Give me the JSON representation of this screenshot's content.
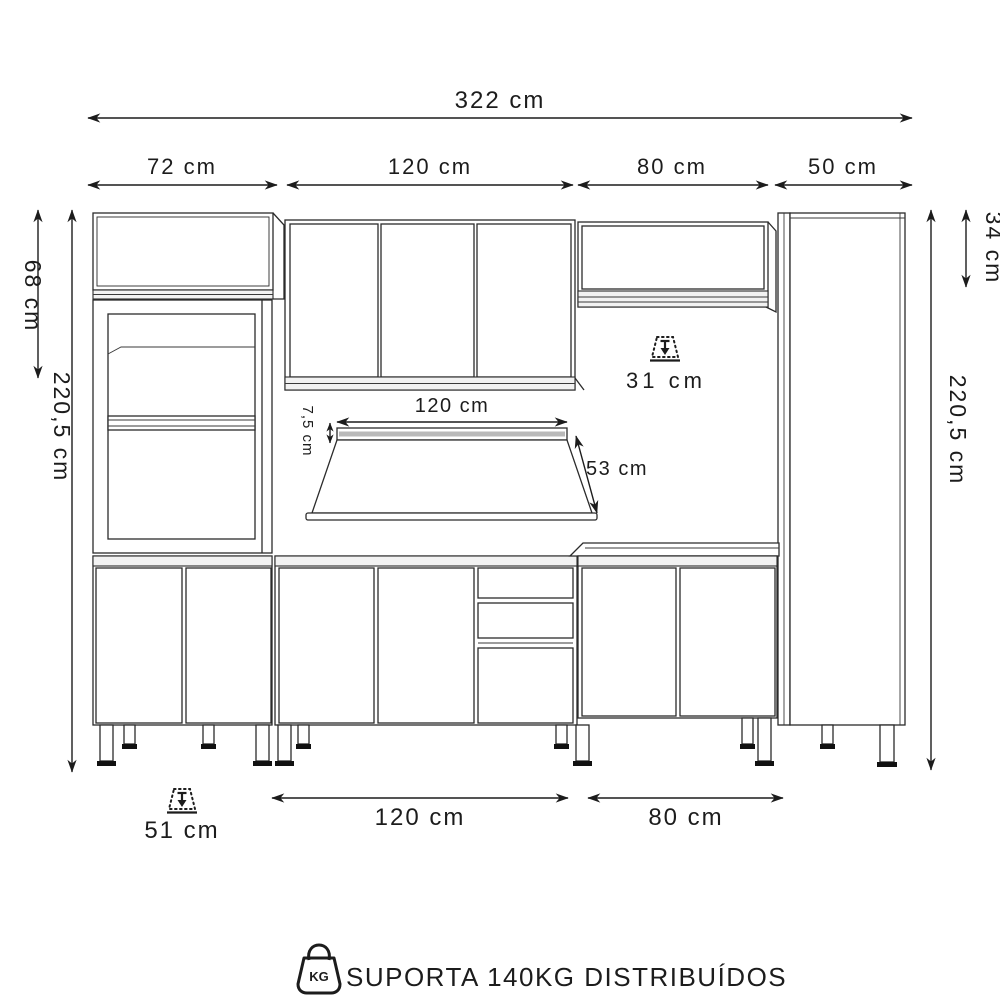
{
  "diagram": {
    "overall_width": "322 cm",
    "section_widths": {
      "left_cabinet": "72 cm",
      "wall_cabinet": "120 cm",
      "upper_cabinet": "80 cm",
      "tall_cabinet": "50 cm"
    },
    "heights": {
      "left_upper_cabinet": "68 cm",
      "left_total": "220,5 cm",
      "right_upper_cabinet": "34 cm",
      "right_total": "220,5 cm"
    },
    "depths": {
      "upper_cabinets": "31 cm",
      "base_cabinets": "51 cm"
    },
    "countertop": {
      "width": "120 cm",
      "thickness": "7,5 cm",
      "depth": "53 cm"
    },
    "base_widths": {
      "center_cabinet": "120 cm",
      "right_cabinet": "80 cm"
    },
    "footer": {
      "weight_icon_label": "KG",
      "text": "SUPORTA 140KG DISTRIBUÍDOS"
    }
  }
}
